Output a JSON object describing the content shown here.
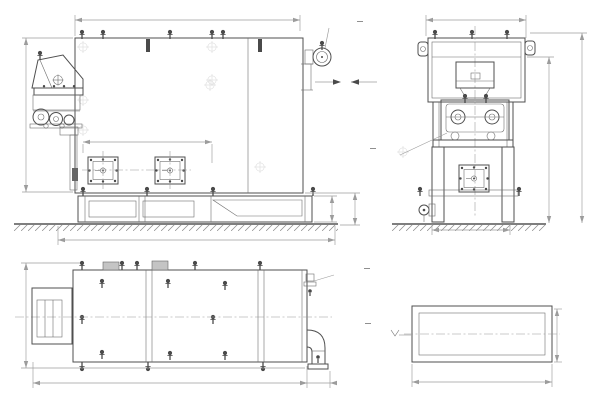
{
  "drawing_type": "technical engineering drawing (boiler unit, 3 projections + detail)",
  "language": "ru",
  "colors": {
    "background": "#ffffff",
    "main_line": "#4f4f4f",
    "dim_line": "#9c9c9c",
    "dim_text": "#a0a0a0",
    "label_text": "#7d7d7d"
  },
  "views": {
    "front": {
      "dims": {
        "width_top": "5405",
        "height_left": "3070",
        "firebox_span": "3515",
        "width_bottom": "5875",
        "base_height": "550",
        "foundation_height": "610"
      },
      "labels": {
        "water_outlet_line1": "Отвод воды",
        "water_outlet_line2": "Ду 200",
        "gas_outlet_line1": "Выход",
        "gas_outlet_line2": "газов",
        "section_letter": "А"
      }
    },
    "side": {
      "dims": {
        "width_top": "2235",
        "height_body": "3170",
        "height_total": "3620",
        "base_width": "1380"
      },
      "labels": {
        "feeder": "Питатель"
      }
    },
    "plan": {
      "dims": {
        "depth_left": "2095",
        "length_bottom": "6755",
        "pipe_offset": "300"
      },
      "labels": {
        "water_inlet_line1": "Подвод воды",
        "water_inlet_line2": "Ду 200"
      }
    },
    "detail": {
      "title": "А (1:5)",
      "dims": {
        "width": "1200",
        "height": "400"
      },
      "elevation_mark": "+2,750"
    }
  }
}
